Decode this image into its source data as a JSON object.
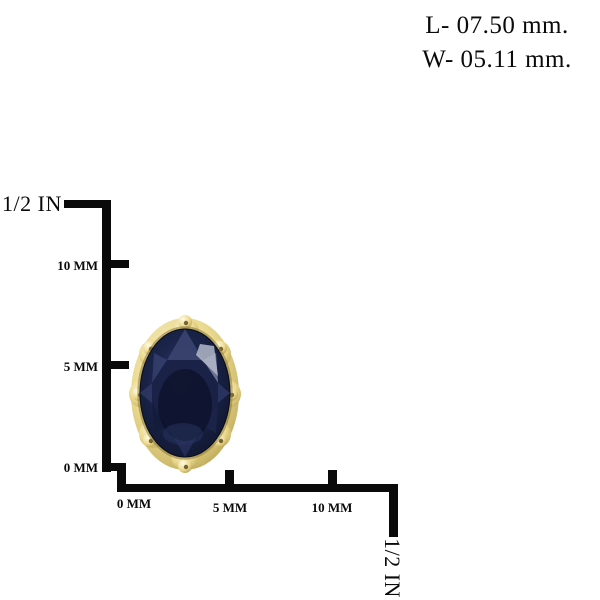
{
  "measurements": {
    "length": "L- 07.50 mm.",
    "width": "W- 05.11 mm."
  },
  "vertical_ruler": {
    "unit_label": "1/2 IN",
    "tick_10": "10 MM",
    "tick_5": "5 MM",
    "tick_0": "0 MM"
  },
  "horizontal_ruler": {
    "tick_0": "0 MM",
    "tick_5": "5 MM",
    "tick_10": "10 MM",
    "unit_label": "1/2 IN"
  },
  "product": {
    "description": "oval dark blue sapphire stud earring in ornate beaded gold setting"
  },
  "colors": {
    "background": "#ffffff",
    "ruler_and_text": "#0a0a0a",
    "gold_setting": "#e6d796",
    "gold_highlight": "#faf3cf",
    "gold_shadow": "#b09b4b",
    "stone_dark": "#0d1329",
    "stone_mid": "#1a2449",
    "stone_facet_light": "#b3b8c9"
  }
}
